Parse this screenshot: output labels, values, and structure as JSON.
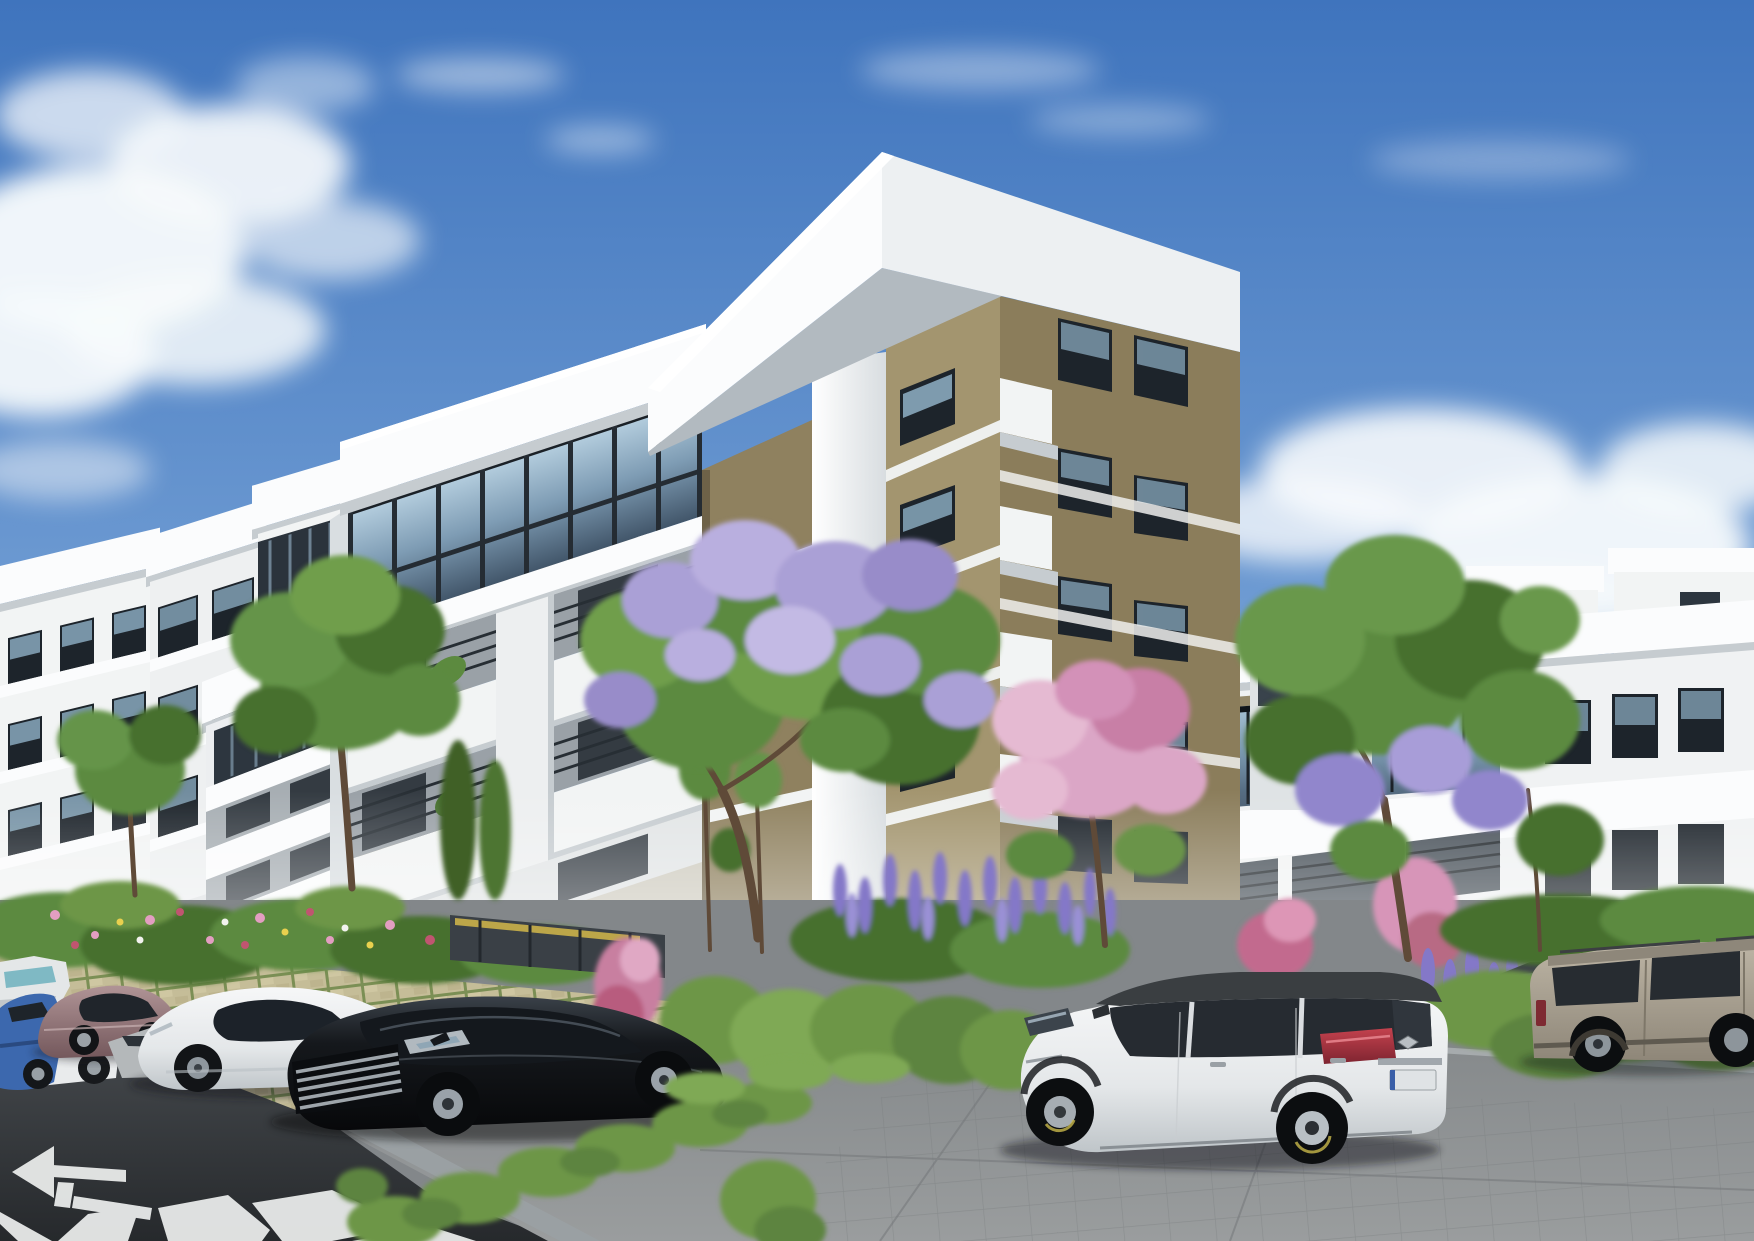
{
  "meta": {
    "title": "Residential apartment complex — exterior architectural rendering",
    "type": "photorealistic-render",
    "width_px": 1754,
    "height_px": 1241,
    "visible_text": "none (license plate present but illegible)"
  },
  "scene": {
    "description": "Daytime rendering of a modern multi-building apartment complex in white and khaki-tan stucco, with flowering landscaping and a foreground parking area holding several cars. Blue sky with white cumulus clouds.",
    "sky": {
      "condition": "partly cloudy",
      "clouds": "large cumulus at upper left and mid right, thin wisps top center"
    },
    "buildings": [
      {
        "id": "left-cluster",
        "label": "left apartment block",
        "floors_visible": 4,
        "colors": [
          "white",
          "tan accents"
        ],
        "features": [
          "stepped white roof slabs",
          "dark glazed band",
          "window balconies"
        ]
      },
      {
        "id": "main-building",
        "label": "central apartment building with corner tower",
        "floors_visible": 5,
        "colors": [
          "white",
          "khaki-tan"
        ],
        "features": [
          "heavy white cornice slab",
          "glass curtain wall on top floor of wing",
          "recessed balconies with railings",
          "small white corner balconies",
          "wide white corner pier"
        ]
      },
      {
        "id": "right-building",
        "label": "right apartment wing",
        "floors_visible": 4,
        "colors": [
          "white",
          "tan end pier"
        ],
        "features": [
          "rooftop penthouse boxes",
          "continuous glazed band",
          "long railed balcony"
        ]
      },
      {
        "id": "distant-building",
        "label": "background building in gap",
        "colors": [
          "white",
          "tan"
        ]
      }
    ],
    "vehicles": [
      {
        "id": "van-white",
        "label": "white minivan, far left edge, partially visible",
        "color": "#e4e7e8"
      },
      {
        "id": "sedan-white-far",
        "label": "white sedan behind the mauve car",
        "color": "#e9ebec"
      },
      {
        "id": "sedan-blue",
        "label": "blue sedan, left edge",
        "color": "#3c68ae"
      },
      {
        "id": "sedan-mauve",
        "label": "mauve / rose-bronze sedan",
        "color": "#97797c"
      },
      {
        "id": "sedan-silver",
        "label": "silver sedan, mostly hidden",
        "color": "#b4b8ba"
      },
      {
        "id": "sedan-white",
        "label": "white fastback sedan",
        "color": "#eef0f1"
      },
      {
        "id": "sedan-black",
        "label": "glossy black sedan with chrome grille",
        "color": "#17191d"
      },
      {
        "id": "suv-white",
        "label": "white crossover SUV with dark roof (Renault Captur style), blank license plate, diamond badge",
        "color": "#e9ebec",
        "roof_color": "#3a3e41",
        "taillight": "#a93540"
      },
      {
        "id": "sedan-dark-hidden",
        "label": "dark sedan behind right hedge",
        "color": "#3e434a"
      },
      {
        "id": "suv-beige",
        "label": "beige compact SUV (Jeep Renegade style), right edge",
        "color": "#ada595"
      }
    ],
    "landscaping": [
      {
        "id": "tree-lilac-center",
        "label": "large tree with lilac blossoms in front of tower"
      },
      {
        "id": "tree-pink",
        "label": "pink flowering tree right of center"
      },
      {
        "id": "tree-jacaranda-right",
        "label": "tall green/purple flowering tree before right building"
      },
      {
        "id": "trees-left",
        "label": "green trees in front of left block"
      },
      {
        "id": "wisteria",
        "label": "purple flower spikes in central flowerbed"
      },
      {
        "id": "hedges",
        "label": "trimmed bright-green hedges between parking rows"
      },
      {
        "id": "flowerbed",
        "label": "mixed flowerbed with pink, red, yellow and white blooms"
      }
    ],
    "ground": {
      "surfaces": [
        "dark asphalt roadway (lower left)",
        "grass-grid paver parking strip",
        "grey concrete parking lot (right)"
      ],
      "markings": [
        "white left-pointing turn arrow",
        "white crosswalk zebra stripes",
        "white edge lines",
        "yellow wheel stop"
      ]
    }
  },
  "palette": {
    "sky_top": "#3f74bd",
    "sky_mid": "#7fa8d9",
    "sky_horizon": "#cfe0ee",
    "cloud": "#f7fafc",
    "facade_white": "#f2f4f4",
    "facade_bright": "#fbfcfd",
    "facade_shadow": "#c6ccd0",
    "tan_light": "#a3956f",
    "tan_dark": "#8b7d5b",
    "window_frame": "#1d242b",
    "window_glass": "#8fb0c6",
    "glass_band": "#46586a",
    "hedge": "#6d9647",
    "foliage": "#5c8a3f",
    "foliage_dark": "#46702f",
    "lilac": "#aaa0d6",
    "pink": "#dba6c6",
    "purple": "#8478c8",
    "asphalt": "#36393d",
    "concrete": "#8f9294",
    "paver": "#c5bd98",
    "paver_green": "#7b8f55",
    "marking": "#eef0ef",
    "trunk": "#5f4a38",
    "red_flower": "#c05570",
    "yellow_accent": "#d3b94a",
    "taillight": "#a93540"
  }
}
